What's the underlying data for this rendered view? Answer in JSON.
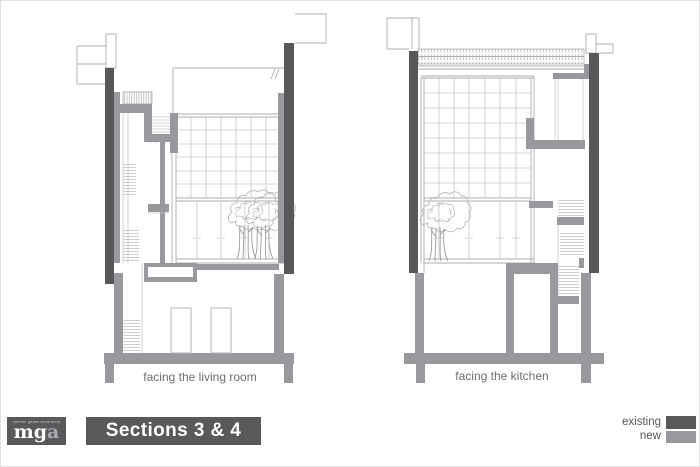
{
  "sections": [
    {
      "caption": "facing the living room"
    },
    {
      "caption": "facing the kitchen"
    }
  ],
  "footer": {
    "logo_primary": "mg",
    "logo_secondary": "a",
    "logo_tagline": "meirav galan architects",
    "title": "Sections 3 & 4"
  },
  "legend": {
    "items": [
      {
        "label": "existing",
        "color": "#58595b"
      },
      {
        "label": "new",
        "color": "#97999c"
      }
    ]
  }
}
